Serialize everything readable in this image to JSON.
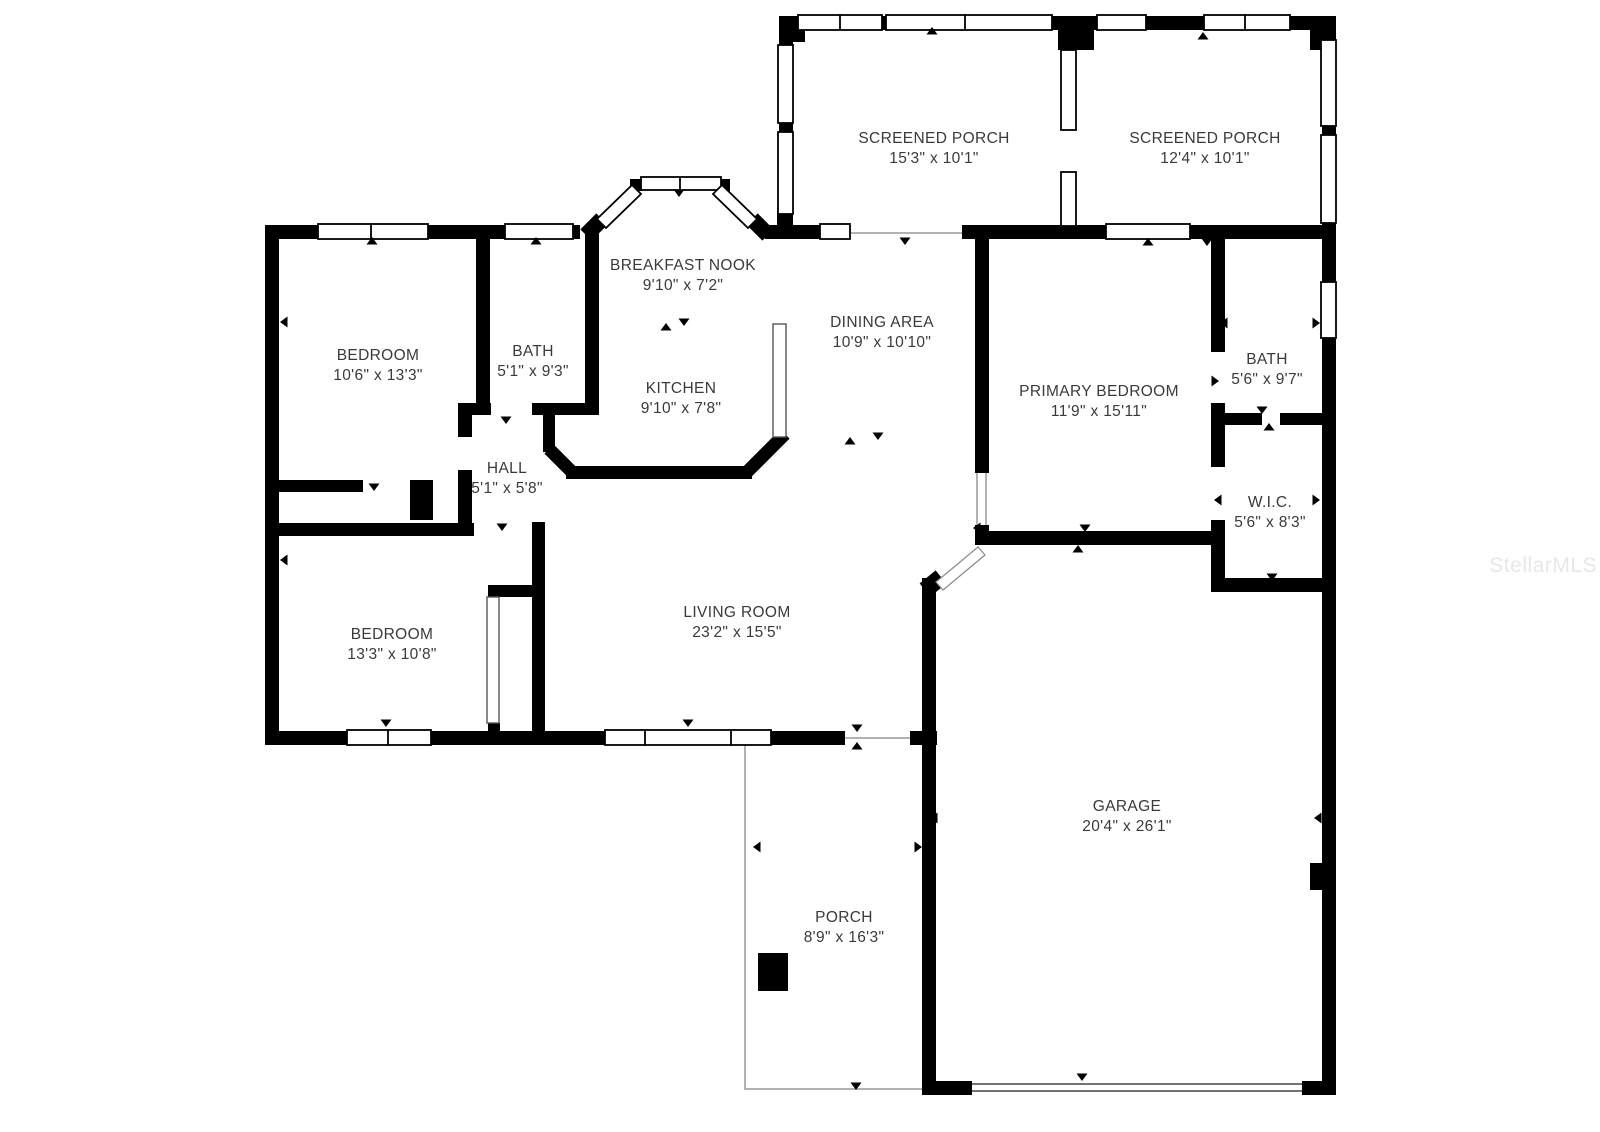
{
  "plan_title": "Single-story residential floor plan",
  "rooms": [
    {
      "id": "screened-porch-left",
      "name": "SCREENED PORCH",
      "dims": "15'3\" x 10'1\""
    },
    {
      "id": "screened-porch-right",
      "name": "SCREENED PORCH",
      "dims": "12'4\" x 10'1\""
    },
    {
      "id": "breakfast-nook",
      "name": "BREAKFAST NOOK",
      "dims": "9'10\" x 7'2\""
    },
    {
      "id": "dining-area",
      "name": "DINING AREA",
      "dims": "10'9\" x 10'10\""
    },
    {
      "id": "kitchen",
      "name": "KITCHEN",
      "dims": "9'10\" x 7'8\""
    },
    {
      "id": "bedroom-top-left",
      "name": "BEDROOM",
      "dims": "10'6\" x 13'3\""
    },
    {
      "id": "bath-left",
      "name": "BATH",
      "dims": "5'1\" x 9'3\""
    },
    {
      "id": "hall",
      "name": "HALL",
      "dims": "5'1\" x 5'8\""
    },
    {
      "id": "primary-bedroom",
      "name": "PRIMARY BEDROOM",
      "dims": "11'9\" x 15'11\""
    },
    {
      "id": "bath-right",
      "name": "BATH",
      "dims": "5'6\" x 9'7\""
    },
    {
      "id": "walk-in-closet",
      "name": "W.I.C.",
      "dims": "5'6\" x 8'3\""
    },
    {
      "id": "bedroom-bottom-left",
      "name": "BEDROOM",
      "dims": "13'3\" x 10'8\""
    },
    {
      "id": "living-room",
      "name": "LIVING ROOM",
      "dims": "23'2\" x 15'5\""
    },
    {
      "id": "garage",
      "name": "GARAGE",
      "dims": "20'4\" x 26'1\""
    },
    {
      "id": "porch",
      "name": "PORCH",
      "dims": "8'9\" x 16'3\""
    }
  ],
  "watermark": {
    "text": "StellarMLS"
  },
  "colors": {
    "wall": "#000000",
    "label_text": "#3a3a3a",
    "watermark": "#e7e7e7",
    "thin_line": "#999999"
  }
}
